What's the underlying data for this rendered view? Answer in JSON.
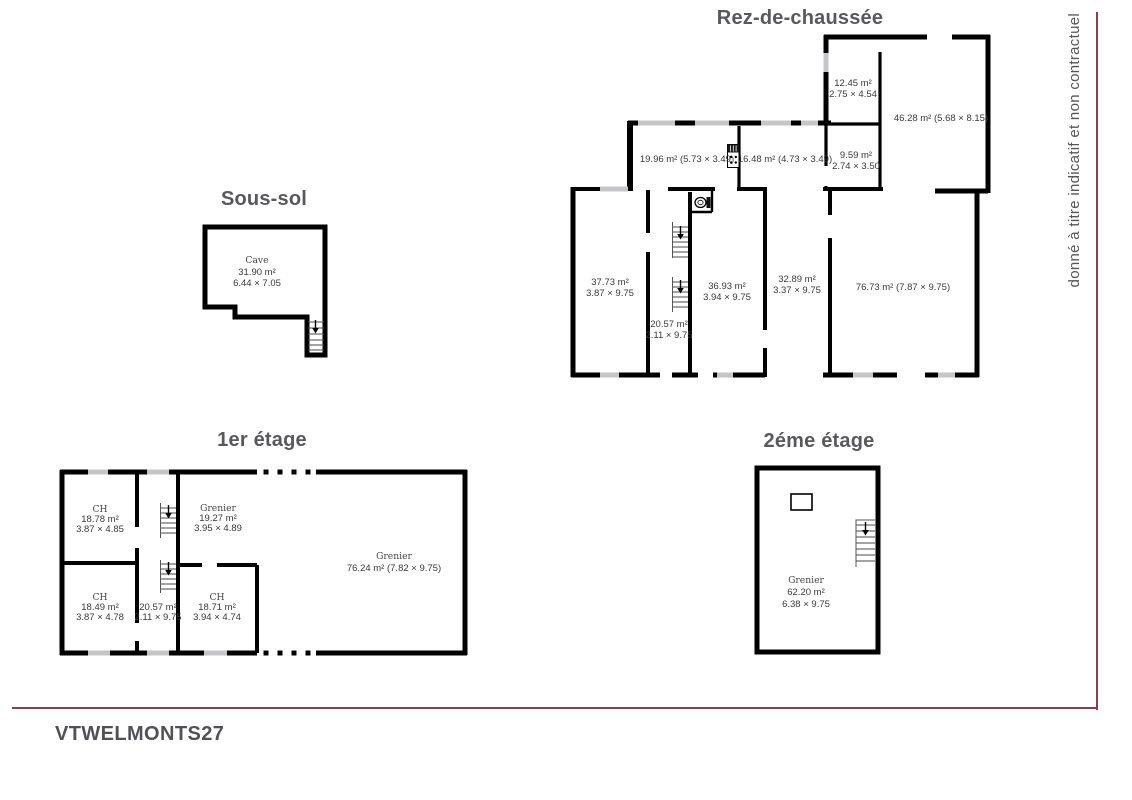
{
  "page": {
    "disclaimer": "donné à titre indicatif et non contractuel",
    "footer_code": "VTWELMONTS27",
    "accent_color": "#8a3d4f",
    "wall_color": "#000000",
    "window_color": "#c4c5c7",
    "title_color": "#58595c"
  },
  "floors": {
    "sous_sol": {
      "title": "Sous-sol",
      "rooms": {
        "cave": {
          "name": "Cave",
          "area": "31.90 m²",
          "dims": "6.44 × 7.05"
        }
      }
    },
    "rdc": {
      "title": "Rez-de-chaussée",
      "rooms": {
        "r1245": {
          "area": "12.45 m²",
          "dims": "2.75 × 4.54"
        },
        "r4628": {
          "label": "46.28 m² (5.68 × 8.15)"
        },
        "r1996": {
          "label": "19.96 m² (5.73 × 3.49)"
        },
        "r1648": {
          "label": "16.48 m² (4.73 × 3.49)"
        },
        "r959": {
          "area": "9.59 m²",
          "dims": "2.74 × 3.50"
        },
        "r3773": {
          "area": "37.73 m²",
          "dims": "3.87 × 9.75"
        },
        "r2057": {
          "area": "20.57 m²",
          "dims": "2.11 × 9.75"
        },
        "r3693": {
          "area": "36.93 m²",
          "dims": "3.94 × 9.75"
        },
        "r3289": {
          "area": "32.89 m²",
          "dims": "3.37 × 9.75"
        },
        "r7673": {
          "label": "76.73 m² (7.87 × 9.75)"
        }
      }
    },
    "etage1": {
      "title": "1er étage",
      "rooms": {
        "ch_nw": {
          "name": "CH",
          "area": "18.78 m²",
          "dims": "3.87 × 4.85"
        },
        "grenier_n": {
          "name": "Grenier",
          "area": "19.27 m²",
          "dims": "3.95 × 4.89"
        },
        "grenier_e": {
          "name": "Grenier",
          "label": "76.24 m² (7.82 × 9.75)"
        },
        "ch_sw": {
          "name": "CH",
          "area": "18.49 m²",
          "dims": "3.87 × 4.78"
        },
        "hall": {
          "area": "20.57 m²",
          "dims": "2.11 × 9.75"
        },
        "ch_s": {
          "name": "CH",
          "area": "18.71 m²",
          "dims": "3.94 × 4.74"
        }
      }
    },
    "etage2": {
      "title": "2éme étage",
      "rooms": {
        "grenier": {
          "name": "Grenier",
          "area": "62.20 m²",
          "dims": "6.38 × 9.75"
        }
      }
    }
  },
  "icons": {
    "stairs_arrow": "↓",
    "toilet": "toilet-icon",
    "stove": "stove-icon",
    "chimney": "chimney-icon"
  }
}
